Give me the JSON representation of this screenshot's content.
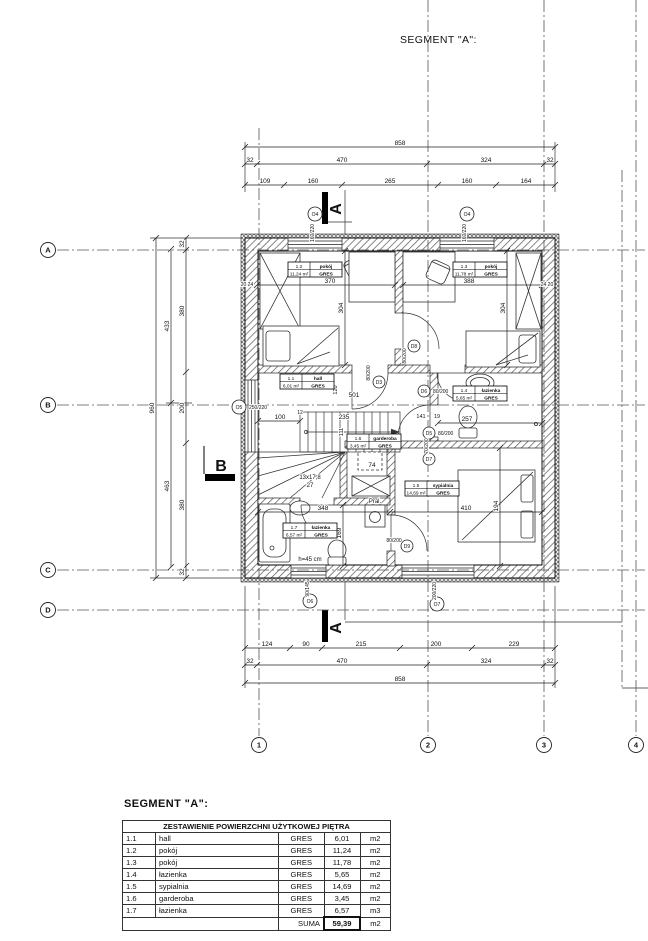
{
  "titles": {
    "top": "SEGMENT \"A\":",
    "bottom": "SEGMENT \"A\":"
  },
  "table": {
    "header": "ZESTAWIENIE POWIERZCHNI UŻYTKOWEJ PIĘTRA",
    "rows": [
      {
        "id": "1.1",
        "name": "hall",
        "finish": "GRES",
        "area": "6,01",
        "unit": "m2"
      },
      {
        "id": "1.2",
        "name": "pokój",
        "finish": "GRES",
        "area": "11,24",
        "unit": "m2"
      },
      {
        "id": "1.3",
        "name": "pokój",
        "finish": "GRES",
        "area": "11,78",
        "unit": "m2"
      },
      {
        "id": "1.4",
        "name": "łazienka",
        "finish": "GRES",
        "area": "5,65",
        "unit": "m2"
      },
      {
        "id": "1.5",
        "name": "sypialnia",
        "finish": "GRES",
        "area": "14,69",
        "unit": "m2"
      },
      {
        "id": "1.6",
        "name": "garderoba",
        "finish": "GRES",
        "area": "3,45",
        "unit": "m2"
      },
      {
        "id": "1.7",
        "name": "łazienka",
        "finish": "GRES",
        "area": "6,57",
        "unit": "m3"
      }
    ],
    "sum_label": "SUMA",
    "sum_value": "59,39",
    "sum_unit": "m2"
  },
  "plan": {
    "axes_rows": [
      {
        "l": "A",
        "y": 250
      },
      {
        "l": "B",
        "y": 405
      },
      {
        "l": "C",
        "y": 570
      },
      {
        "l": "D",
        "y": 610
      }
    ],
    "axes_cols": [
      {
        "l": "1",
        "x": 259,
        "y1": 128
      },
      {
        "l": "2",
        "x": 428,
        "y1": 0
      },
      {
        "l": "3",
        "x": 544,
        "y1": 0
      },
      {
        "l": "4",
        "x": 636,
        "y1": 0
      }
    ],
    "chains_h": [
      {
        "y": 147,
        "x1": 245,
        "x2": 555,
        "ticks": [
          245,
          555
        ],
        "labels": [
          {
            "t": "858",
            "x": 400
          }
        ]
      },
      {
        "y": 164,
        "x1": 245,
        "x2": 555,
        "ticks": [
          245,
          257,
          427,
          544,
          555
        ],
        "labels": [
          {
            "t": "32",
            "x": 250
          },
          {
            "t": "470",
            "x": 342
          },
          {
            "t": "324",
            "x": 486
          },
          {
            "t": "32",
            "x": 550
          }
        ]
      },
      {
        "y": 185,
        "x1": 245,
        "x2": 555,
        "ticks": [
          245,
          284,
          342,
          438,
          496,
          555
        ],
        "labels": [
          {
            "t": "109",
            "x": 265
          },
          {
            "t": "160",
            "x": 313
          },
          {
            "t": "265",
            "x": 390
          },
          {
            "t": "160",
            "x": 467
          },
          {
            "t": "164",
            "x": 526
          }
        ]
      },
      {
        "y": 648,
        "x1": 245,
        "x2": 555,
        "ticks": [
          245,
          290,
          322,
          400,
          472,
          555
        ],
        "labels": [
          {
            "t": "124",
            "x": 267
          },
          {
            "t": "90",
            "x": 306
          },
          {
            "t": "215",
            "x": 361
          },
          {
            "t": "200",
            "x": 436
          },
          {
            "t": "229",
            "x": 514
          }
        ]
      },
      {
        "y": 665,
        "x1": 245,
        "x2": 555,
        "ticks": [
          245,
          257,
          427,
          544,
          555
        ],
        "labels": [
          {
            "t": "32",
            "x": 250
          },
          {
            "t": "470",
            "x": 342
          },
          {
            "t": "324",
            "x": 486
          },
          {
            "t": "32",
            "x": 550
          }
        ]
      },
      {
        "y": 683,
        "x1": 245,
        "x2": 555,
        "ticks": [
          245,
          555
        ],
        "labels": [
          {
            "t": "858",
            "x": 400
          }
        ]
      },
      {
        "y": 285,
        "x1": 257,
        "x2": 395,
        "ticks": [
          257,
          395
        ],
        "labels": [
          {
            "t": "370",
            "x": 330
          }
        ]
      },
      {
        "y": 285,
        "x1": 403,
        "x2": 542,
        "ticks": [
          403,
          542
        ],
        "labels": [
          {
            "t": "388",
            "x": 469
          }
        ]
      },
      {
        "y": 423,
        "x1": 438,
        "x2": 542,
        "ticks": [
          438,
          542
        ],
        "labels": [
          {
            "t": "257",
            "x": 467
          }
        ]
      },
      {
        "y": 512,
        "x1": 258,
        "x2": 542,
        "ticks": [
          258,
          390,
          542
        ],
        "labels": [
          {
            "t": "348",
            "x": 323
          },
          {
            "t": "410",
            "x": 466
          }
        ]
      },
      {
        "y": 421,
        "x1": 258,
        "x2": 300,
        "ticks": [
          258,
          300
        ],
        "labels": [
          {
            "t": "100",
            "x": 280
          }
        ]
      }
    ],
    "chains_v": [
      {
        "x": 156,
        "y1": 238,
        "y2": 578,
        "ticks": [
          238,
          578
        ],
        "labels": [
          {
            "t": "960",
            "y": 408
          }
        ]
      },
      {
        "x": 171,
        "y1": 249,
        "y2": 567,
        "ticks": [
          249,
          403,
          567
        ],
        "labels": [
          {
            "t": "433",
            "y": 326
          },
          {
            "t": "463",
            "y": 486
          }
        ]
      },
      {
        "x": 186,
        "y1": 238,
        "y2": 578,
        "ticks": [
          238,
          250,
          372,
          443,
          566,
          578
        ],
        "labels": [
          {
            "t": "32",
            "y": 244
          },
          {
            "t": "380",
            "y": 311
          },
          {
            "t": "200",
            "y": 408
          },
          {
            "t": "380",
            "y": 505
          },
          {
            "t": "32",
            "y": 572
          }
        ]
      },
      {
        "x": 345,
        "y1": 251,
        "y2": 365,
        "ticks": [
          251,
          365
        ],
        "labels": [
          {
            "t": "304",
            "y": 308
          }
        ]
      },
      {
        "x": 507,
        "y1": 251,
        "y2": 365,
        "ticks": [
          251,
          365
        ],
        "labels": [
          {
            "t": "304",
            "y": 308
          }
        ]
      },
      {
        "x": 343,
        "y1": 505,
        "y2": 566,
        "ticks": [
          505,
          566
        ],
        "labels": [
          {
            "t": "169",
            "y": 533
          }
        ]
      },
      {
        "x": 500,
        "y1": 448,
        "y2": 566,
        "ticks": [
          448,
          566
        ],
        "labels": [
          {
            "t": "194",
            "y": 506
          }
        ]
      }
    ],
    "free_labels": [
      {
        "t": "501",
        "x": 354,
        "y": 397
      },
      {
        "t": "235",
        "x": 344,
        "y": 419
      },
      {
        "t": "141",
        "x": 421,
        "y": 418,
        "s": 5.5
      },
      {
        "t": "19",
        "x": 437,
        "y": 418,
        "s": 5.5
      },
      {
        "t": "120",
        "x": 337,
        "y": 390,
        "rot": 1,
        "s": 5.5
      },
      {
        "t": "111",
        "x": 343,
        "y": 432,
        "rot": 1,
        "s": 5.5
      },
      {
        "t": "74",
        "x": 372,
        "y": 467
      },
      {
        "t": "12",
        "x": 300,
        "y": 414,
        "s": 5
      },
      {
        "t": "13x17,8",
        "x": 310,
        "y": 479,
        "s": 6
      },
      {
        "t": "27",
        "x": 310,
        "y": 487,
        "s": 6
      },
      {
        "t": "h=45 cm",
        "x": 310,
        "y": 561,
        "s": 6
      },
      {
        "t": "Pral.",
        "x": 375,
        "y": 503,
        "s": 6
      },
      {
        "t": "20 24",
        "x": 247,
        "y": 286,
        "s": 5
      },
      {
        "t": "24 20",
        "x": 547,
        "y": 286,
        "s": 5
      }
    ],
    "big_labels": [
      {
        "t": "A",
        "x": 341,
        "y": 209,
        "rot": 1
      },
      {
        "t": "A",
        "x": 341,
        "y": 628,
        "rot": 1
      },
      {
        "t": "B",
        "x": 221,
        "y": 471
      }
    ],
    "window_markers": [
      {
        "l": "O4",
        "size": "160/220",
        "x": 315,
        "y": 214,
        "sx": 314,
        "sy": 233,
        "srot": 1
      },
      {
        "l": "O4",
        "size": "160/220",
        "x": 467,
        "y": 214,
        "sx": 466,
        "sy": 233,
        "srot": 1
      },
      {
        "l": "O5",
        "size": "250/220",
        "x": 239,
        "y": 407,
        "sx": 249,
        "sy": 409,
        "srot": 0,
        "a": "start"
      },
      {
        "l": "O6",
        "size": "90/145",
        "x": 310,
        "y": 601,
        "sx": 309,
        "sy": 589,
        "srot": 1
      },
      {
        "l": "O7",
        "size": "200/220",
        "x": 437,
        "y": 604,
        "sx": 436,
        "sy": 591,
        "srot": 1
      }
    ],
    "door_markers": [
      {
        "l": "D3",
        "size": "80/200",
        "x": 379,
        "y": 382,
        "sx": 370,
        "sy": 373,
        "srot": 1
      },
      {
        "l": "D8",
        "size": "80/200",
        "x": 414,
        "y": 346,
        "sx": 406,
        "sy": 356,
        "srot": 1
      },
      {
        "l": "D6",
        "size": "80/200",
        "x": 424,
        "y": 391,
        "sx": 433,
        "sy": 393,
        "srot": 0,
        "a": "start"
      },
      {
        "l": "D5",
        "size": "80/200",
        "x": 429,
        "y": 433,
        "sx": 438,
        "sy": 435,
        "srot": 0,
        "a": "start"
      },
      {
        "l": "D7",
        "size": "70/200",
        "x": 429,
        "y": 459,
        "sx": 428,
        "sy": 446,
        "srot": 1
      },
      {
        "l": "D9",
        "size": "80/200",
        "x": 407,
        "y": 546,
        "sx": 394,
        "sy": 542,
        "srot": 0
      }
    ],
    "room_tags": [
      {
        "id": "1.1",
        "name": "hall",
        "area": "6,01 m²",
        "finish": "GRES",
        "x": 280,
        "y": 374
      },
      {
        "id": "1.2",
        "name": "pokój",
        "area": "11,24 m²",
        "finish": "GRES",
        "x": 288,
        "y": 262
      },
      {
        "id": "1.3",
        "name": "pokój",
        "area": "11,78 m²",
        "finish": "GRES",
        "x": 453,
        "y": 262
      },
      {
        "id": "1.4",
        "name": "łazienka",
        "area": "5,65 m²",
        "finish": "GRES",
        "x": 453,
        "y": 386
      },
      {
        "id": "1.5",
        "name": "sypialnia",
        "area": "14,69 m²",
        "finish": "GRES",
        "x": 405,
        "y": 481
      },
      {
        "id": "1.6",
        "name": "garderoba",
        "area": "3,45 m²",
        "finish": "GRES",
        "x": 347,
        "y": 434
      },
      {
        "id": "1.7",
        "name": "łazienka",
        "area": "6,57 m²",
        "finish": "GRES",
        "x": 283,
        "y": 523
      }
    ]
  }
}
